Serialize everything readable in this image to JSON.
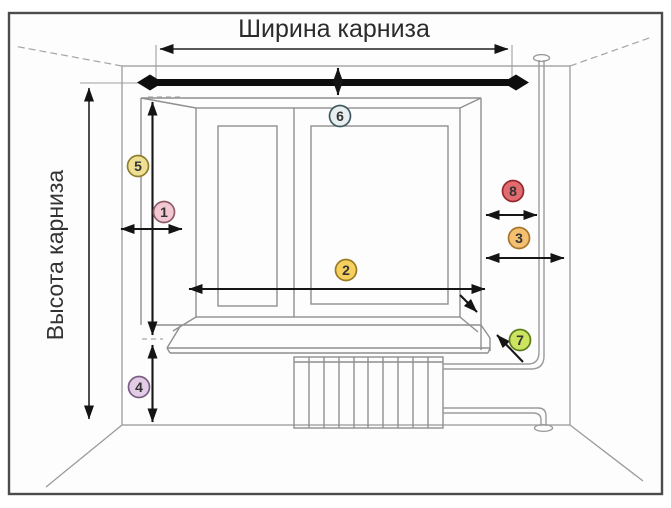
{
  "diagram": {
    "title_top": "Ширина карниза",
    "title_left": "Высота карниза",
    "border_color": "#4c4c4c",
    "markers": [
      {
        "n": "1",
        "x": 164,
        "y": 212,
        "fill": "#f2c9d3",
        "stroke": "#8f5a68"
      },
      {
        "n": "2",
        "x": 346,
        "y": 270,
        "fill": "#f6d05e",
        "stroke": "#9a7a25"
      },
      {
        "n": "3",
        "x": 519,
        "y": 238,
        "fill": "#f4bf70",
        "stroke": "#a5762a"
      },
      {
        "n": "4",
        "x": 139,
        "y": 387,
        "fill": "#e3cde6",
        "stroke": "#7a5d85"
      },
      {
        "n": "5",
        "x": 138,
        "y": 166,
        "fill": "#eedf93",
        "stroke": "#8f7d33"
      },
      {
        "n": "6",
        "x": 340,
        "y": 116,
        "fill": "#e9eff1",
        "stroke": "#3f5a63"
      },
      {
        "n": "7",
        "x": 520,
        "y": 340,
        "fill": "#cce45f",
        "stroke": "#5a7a1a"
      },
      {
        "n": "8",
        "x": 513,
        "y": 191,
        "fill": "#e16b6e",
        "stroke": "#93292e"
      }
    ]
  }
}
